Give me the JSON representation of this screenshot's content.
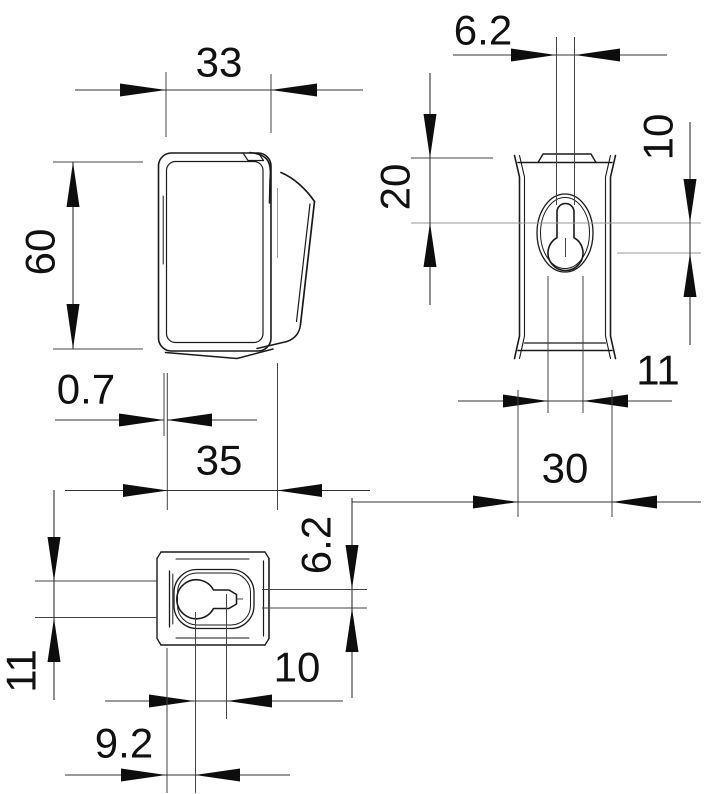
{
  "drawing": {
    "type": "technical-dimension-drawing",
    "part": "mounting grip clip with keyhole slot",
    "colors": {
      "background": "#ffffff",
      "line": "#1a1a1a",
      "dimension": "#111111"
    },
    "views": {
      "side": {
        "name": "side view",
        "dims": {
          "width": "33",
          "height": "60",
          "thickness": "0.7"
        }
      },
      "front": {
        "name": "front view",
        "dims": {
          "slot_width": "6.2",
          "edge_to_center": "20",
          "center_to_hole": "10",
          "hole_diameter": "11",
          "body_width": "30"
        }
      },
      "top": {
        "name": "top view",
        "dims": {
          "overall_depth": "35",
          "hole_diameter": "11",
          "wall_to_center": "9.2",
          "center_to_slot_end": "10",
          "slot_width": "6.2"
        }
      }
    }
  }
}
